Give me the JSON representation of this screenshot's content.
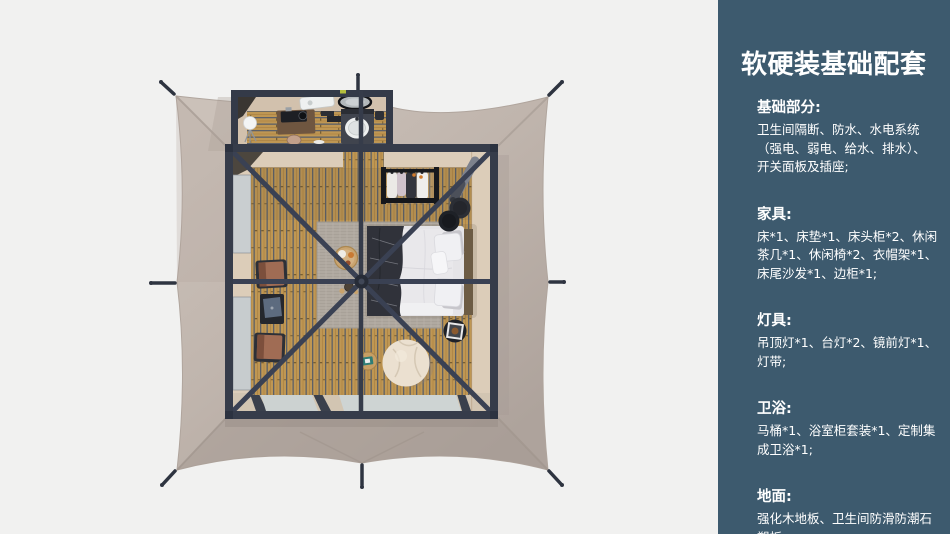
{
  "sidebar": {
    "background_color": "#3d5a6e",
    "text_color": "#ffffff",
    "title": "软硬装基础配套",
    "sections": [
      {
        "heading": "基础部分:",
        "body": "卫生间隔断、防水、水电系统（强电、弱电、给水、排水）、开关面板及插座;"
      },
      {
        "heading": "家具:",
        "body": "床*1、床垫*1、床头柜*2、休闲茶几*1、休闲椅*2、衣帽架*1、床尾沙发*1、边柜*1;"
      },
      {
        "heading": "灯具:",
        "body": "吊顶灯*1、台灯*2、镜前灯*1、灯带;"
      },
      {
        "heading": "卫浴:",
        "body": "马桶*1、浴室柜套装*1、定制集成卫浴*1;"
      },
      {
        "heading": "地面:",
        "body": "强化木地板、卫生间防滑防潮石塑板;"
      }
    ]
  },
  "floorplan": {
    "view": "top-down render of square glamping tent with bedroom and bathroom annex",
    "background_color": "#f1f1f0",
    "tent_canvas_color": "#c2b7af",
    "frame_color": "#363c4a",
    "wood_floor_color": "#bf9753",
    "rug_color": "#b0a9a0",
    "objects": [
      "tent-canvas",
      "guy-stakes",
      "bathroom-annex",
      "sphere-lamp",
      "vanity-desk",
      "vanity-stool",
      "sink-counter",
      "wall-mirror",
      "shower-tub-unit",
      "toilet",
      "bath-mat",
      "bedroom",
      "left-windows",
      "bottom-glass-doors",
      "area-rug",
      "double-bed",
      "throw-blanket",
      "pillows",
      "clothes-rack",
      "leaning-lamp",
      "black-stools",
      "photo-side-table",
      "bean-bag",
      "tea-table",
      "breakfast-tray",
      "tea-set",
      "lounge-chair",
      "side-shelf",
      "roof-frame",
      "center-pole",
      "hub"
    ]
  }
}
